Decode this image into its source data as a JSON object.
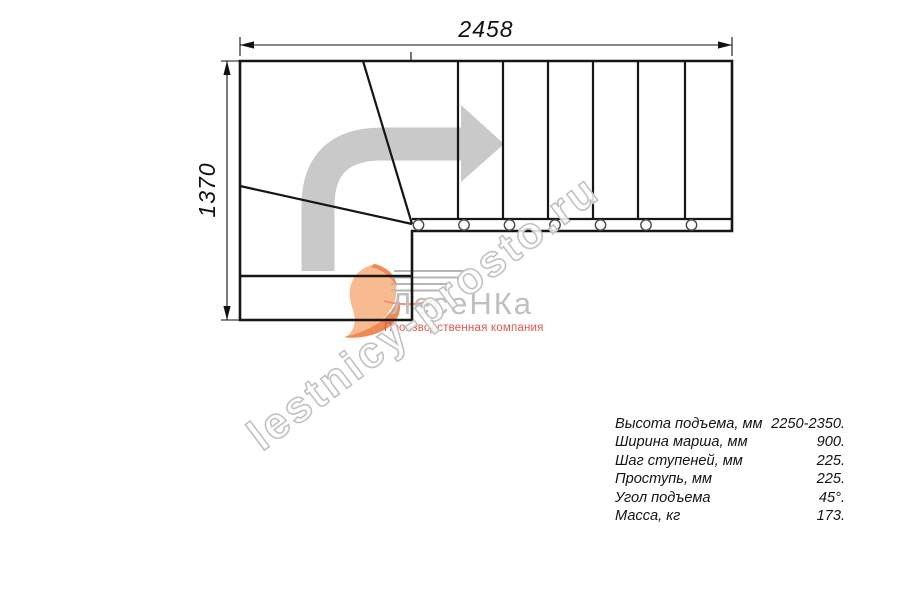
{
  "drawing": {
    "type": "stair-plan-top-view",
    "top_dimension_mm": "2458",
    "left_dimension_mm": "1370"
  },
  "specs": {
    "rows": [
      {
        "label": "Высота подъема, мм",
        "value": "2250-2350."
      },
      {
        "label": "Ширина марша, мм",
        "value": "900."
      },
      {
        "label": "Шаг ступеней, мм",
        "value": "225."
      },
      {
        "label": "Проступь, мм",
        "value": "225."
      },
      {
        "label": "Угол подъема",
        "value": "45°."
      },
      {
        "label": "Масса, кг",
        "value": "173."
      }
    ]
  },
  "watermark": {
    "domain_text": "lestnicy-prosto.ru",
    "brand_text": "ЛесеНКа",
    "company_text": "Производственная компания"
  },
  "icons": {
    "direction_arrow": "turn-right-route-arrow",
    "balusters": "baluster-post-circles",
    "logo": "orange-swoosh-logo"
  },
  "colors": {
    "line": "#161616",
    "direction_arrow_gray": "#c9c9c9",
    "watermark_outline_gray": "#c2c2c2",
    "brand_gray": "#bfbfbf",
    "logo_orange": "#ef8a55",
    "company_red": "#e2574a",
    "background": "#ffffff"
  }
}
